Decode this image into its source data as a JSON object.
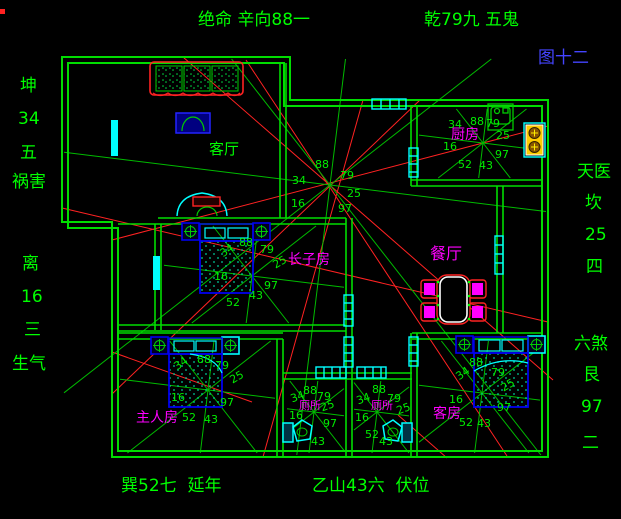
{
  "colors": {
    "background": "#000000",
    "wall_green": "#00dd00",
    "ray_green": "#00bb00",
    "number_green": "#00ee00",
    "label_green": "#00ff00",
    "room_magenta": "#ff00ff",
    "figure_blue": "#4444ff",
    "red_line": "#ff2222",
    "cyan": "#00ffff",
    "furniture_blue": "#0000ee",
    "stove_yellow": "#ffcc00"
  },
  "palaces": {
    "house_center": [
      "34",
      "88",
      "79",
      "16",
      "25",
      "97"
    ],
    "eldest_son_room": [
      "34",
      "88",
      "79",
      "16",
      "25",
      "52",
      "43",
      "97"
    ],
    "kitchen": [
      "34",
      "88",
      "79",
      "16",
      "25",
      "52",
      "43",
      "97"
    ],
    "master_room": [
      "34",
      "88",
      "79",
      "16",
      "25",
      "52",
      "43",
      "97"
    ],
    "toilet_left": [
      "34",
      "88",
      "79",
      "16",
      "25",
      "43",
      "97"
    ],
    "toilet_right": [
      "34",
      "88",
      "79",
      "16",
      "25",
      "52",
      "43"
    ],
    "guest_room": [
      "34",
      "88",
      "79",
      "16",
      "25",
      "52",
      "43",
      "97"
    ]
  },
  "labels": [
    {
      "name": "top-label-jueming",
      "text": "绝命 辛向88一",
      "x": 198,
      "y": 12,
      "fs": 17,
      "color": "#00ff00"
    },
    {
      "name": "top-label-qian",
      "text": "乾79九 五鬼",
      "x": 424,
      "y": 12,
      "fs": 17,
      "color": "#00ff00"
    },
    {
      "name": "figure-number",
      "text": "图十二",
      "x": 538,
      "y": 50,
      "fs": 17,
      "color": "#4444ff"
    },
    {
      "name": "left-label-kun",
      "text": "坤",
      "x": 20,
      "y": 78,
      "fs": 17,
      "color": "#00ff00"
    },
    {
      "name": "left-label-34",
      "text": "34",
      "x": 18,
      "y": 111,
      "fs": 17,
      "color": "#00ff00"
    },
    {
      "name": "left-label-wu",
      "text": "五",
      "x": 20,
      "y": 145,
      "fs": 17,
      "color": "#00ff00"
    },
    {
      "name": "left-label-huohai",
      "text": "祸害",
      "x": 12,
      "y": 174,
      "fs": 17,
      "color": "#00ff00"
    },
    {
      "name": "left-label-li",
      "text": "离",
      "x": 22,
      "y": 256,
      "fs": 17,
      "color": "#00ff00"
    },
    {
      "name": "left-label-16",
      "text": "16",
      "x": 21,
      "y": 289,
      "fs": 17,
      "color": "#00ff00"
    },
    {
      "name": "left-label-san",
      "text": "三",
      "x": 24,
      "y": 322,
      "fs": 17,
      "color": "#00ff00"
    },
    {
      "name": "left-label-shengqi",
      "text": "生气",
      "x": 12,
      "y": 356,
      "fs": 17,
      "color": "#00ff00"
    },
    {
      "name": "right-label-tianyi",
      "text": "天医",
      "x": 577,
      "y": 164,
      "fs": 17,
      "color": "#00ff00"
    },
    {
      "name": "right-label-kan",
      "text": "坎",
      "x": 585,
      "y": 195,
      "fs": 17,
      "color": "#00ff00"
    },
    {
      "name": "right-label-25",
      "text": "25",
      "x": 585,
      "y": 227,
      "fs": 17,
      "color": "#00ff00"
    },
    {
      "name": "right-label-si",
      "text": "四",
      "x": 586,
      "y": 259,
      "fs": 17,
      "color": "#00ff00"
    },
    {
      "name": "right-label-liusha",
      "text": "六煞",
      "x": 574,
      "y": 336,
      "fs": 17,
      "color": "#00ff00"
    },
    {
      "name": "right-label-gen",
      "text": "艮",
      "x": 583,
      "y": 367,
      "fs": 17,
      "color": "#00ff00"
    },
    {
      "name": "right-label-97",
      "text": "97",
      "x": 581,
      "y": 399,
      "fs": 17,
      "color": "#00ff00"
    },
    {
      "name": "right-label-er",
      "text": "二",
      "x": 582,
      "y": 435,
      "fs": 17,
      "color": "#00ff00"
    },
    {
      "name": "bottom-label-xun",
      "text": "巽52七  延年",
      "x": 121,
      "y": 478,
      "fs": 17,
      "color": "#00ff00"
    },
    {
      "name": "bottom-label-yishan",
      "text": "乙山43六  伏位",
      "x": 312,
      "y": 478,
      "fs": 17,
      "color": "#00ff00"
    },
    {
      "name": "room-label-living",
      "text": "客厅",
      "x": 209,
      "y": 142,
      "fs": 15,
      "color": "#00ff00"
    },
    {
      "name": "room-label-kitchen",
      "text": "厨房",
      "x": 451,
      "y": 128,
      "fs": 14,
      "color": "#ff00ff"
    },
    {
      "name": "room-label-eldest-son",
      "text": "长子房",
      "x": 288,
      "y": 253,
      "fs": 14,
      "color": "#ff00ff"
    },
    {
      "name": "room-label-dining",
      "text": "餐厅",
      "x": 430,
      "y": 246,
      "fs": 16,
      "color": "#ff00ff"
    },
    {
      "name": "room-label-master",
      "text": "主人房",
      "x": 136,
      "y": 411,
      "fs": 14,
      "color": "#ff00ff"
    },
    {
      "name": "room-label-guest",
      "text": "客房",
      "x": 433,
      "y": 407,
      "fs": 14,
      "color": "#ff00ff"
    },
    {
      "name": "room-label-toilet-left",
      "text": "厕所",
      "x": 299,
      "y": 400,
      "fs": 11,
      "color": "#ff00ff"
    },
    {
      "name": "room-label-toilet-right",
      "text": "厕所",
      "x": 371,
      "y": 400,
      "fs": 11,
      "color": "#ff00ff"
    },
    {
      "name": "num-house-88",
      "text": "88",
      "x": 315,
      "y": 159
    },
    {
      "name": "num-house-79",
      "text": "79",
      "x": 340,
      "y": 170
    },
    {
      "name": "num-house-34",
      "text": "34",
      "x": 292,
      "y": 175
    },
    {
      "name": "num-house-25",
      "text": "25",
      "x": 347,
      "y": 188
    },
    {
      "name": "num-house-16",
      "text": "16",
      "x": 291,
      "y": 198
    },
    {
      "name": "num-house-97",
      "text": "97",
      "x": 338,
      "y": 203
    },
    {
      "name": "num-eldest-88",
      "text": "88",
      "x": 239,
      "y": 237
    },
    {
      "name": "num-eldest-79",
      "text": "79",
      "x": 260,
      "y": 244
    },
    {
      "name": "num-eldest-34",
      "text": "34",
      "x": 218,
      "y": 250,
      "rot": -35
    },
    {
      "name": "num-eldest-25",
      "text": "25",
      "x": 271,
      "y": 261,
      "rot": -30
    },
    {
      "name": "num-eldest-16",
      "text": "16",
      "x": 214,
      "y": 271
    },
    {
      "name": "num-eldest-97",
      "text": "97",
      "x": 264,
      "y": 280
    },
    {
      "name": "num-eldest-43",
      "text": "43",
      "x": 249,
      "y": 290
    },
    {
      "name": "num-eldest-52",
      "text": "52",
      "x": 226,
      "y": 297
    },
    {
      "name": "num-kitchen-34",
      "text": "34",
      "x": 448,
      "y": 119
    },
    {
      "name": "num-kitchen-88",
      "text": "88",
      "x": 470,
      "y": 116
    },
    {
      "name": "num-kitchen-79",
      "text": "79",
      "x": 486,
      "y": 118
    },
    {
      "name": "num-kitchen-25",
      "text": "25",
      "x": 496,
      "y": 130
    },
    {
      "name": "num-kitchen-16",
      "text": "16",
      "x": 443,
      "y": 141
    },
    {
      "name": "num-kitchen-97",
      "text": "97",
      "x": 495,
      "y": 149
    },
    {
      "name": "num-kitchen-43",
      "text": "43",
      "x": 479,
      "y": 160
    },
    {
      "name": "num-kitchen-52",
      "text": "52",
      "x": 458,
      "y": 159
    },
    {
      "name": "num-master-34",
      "text": "34",
      "x": 172,
      "y": 363,
      "rot": -35
    },
    {
      "name": "num-master-88",
      "text": "88",
      "x": 197,
      "y": 354
    },
    {
      "name": "num-master-79",
      "text": "79",
      "x": 215,
      "y": 360
    },
    {
      "name": "num-master-25",
      "text": "25",
      "x": 228,
      "y": 376,
      "rot": -30
    },
    {
      "name": "num-master-16",
      "text": "16",
      "x": 171,
      "y": 392
    },
    {
      "name": "num-master-97",
      "text": "97",
      "x": 220,
      "y": 397
    },
    {
      "name": "num-master-52",
      "text": "52",
      "x": 182,
      "y": 412
    },
    {
      "name": "num-master-43",
      "text": "43",
      "x": 204,
      "y": 414
    },
    {
      "name": "num-toiletL-88",
      "text": "88",
      "x": 303,
      "y": 385
    },
    {
      "name": "num-toiletL-79",
      "text": "79",
      "x": 317,
      "y": 391
    },
    {
      "name": "num-toiletL-34",
      "text": "34",
      "x": 289,
      "y": 394,
      "rot": -20
    },
    {
      "name": "num-toiletL-25",
      "text": "25",
      "x": 319,
      "y": 403,
      "rot": -20
    },
    {
      "name": "num-toiletL-16",
      "text": "16",
      "x": 289,
      "y": 410
    },
    {
      "name": "num-toiletL-97",
      "text": "97",
      "x": 323,
      "y": 418
    },
    {
      "name": "num-toiletL-43",
      "text": "43",
      "x": 311,
      "y": 436
    },
    {
      "name": "num-toiletR-88",
      "text": "88",
      "x": 372,
      "y": 384
    },
    {
      "name": "num-toiletR-79",
      "text": "79",
      "x": 387,
      "y": 393
    },
    {
      "name": "num-toiletR-34",
      "text": "34",
      "x": 355,
      "y": 396,
      "rot": -20
    },
    {
      "name": "num-toiletR-25",
      "text": "25",
      "x": 395,
      "y": 406,
      "rot": -20
    },
    {
      "name": "num-toiletR-16",
      "text": "16",
      "x": 355,
      "y": 412
    },
    {
      "name": "num-toiletR-52",
      "text": "52",
      "x": 365,
      "y": 429
    },
    {
      "name": "num-toiletR-43",
      "text": "43",
      "x": 379,
      "y": 436
    },
    {
      "name": "num-guest-34",
      "text": "34",
      "x": 454,
      "y": 373,
      "rot": -35
    },
    {
      "name": "num-guest-88",
      "text": "88",
      "x": 469,
      "y": 357
    },
    {
      "name": "num-guest-79",
      "text": "79",
      "x": 491,
      "y": 367
    },
    {
      "name": "num-guest-25",
      "text": "25",
      "x": 499,
      "y": 384,
      "rot": -30
    },
    {
      "name": "num-guest-16",
      "text": "16",
      "x": 449,
      "y": 394
    },
    {
      "name": "num-guest-97",
      "text": "97",
      "x": 497,
      "y": 402
    },
    {
      "name": "num-guest-52",
      "text": "52",
      "x": 459,
      "y": 417
    },
    {
      "name": "num-guest-43",
      "text": "43",
      "x": 477,
      "y": 418
    }
  ]
}
